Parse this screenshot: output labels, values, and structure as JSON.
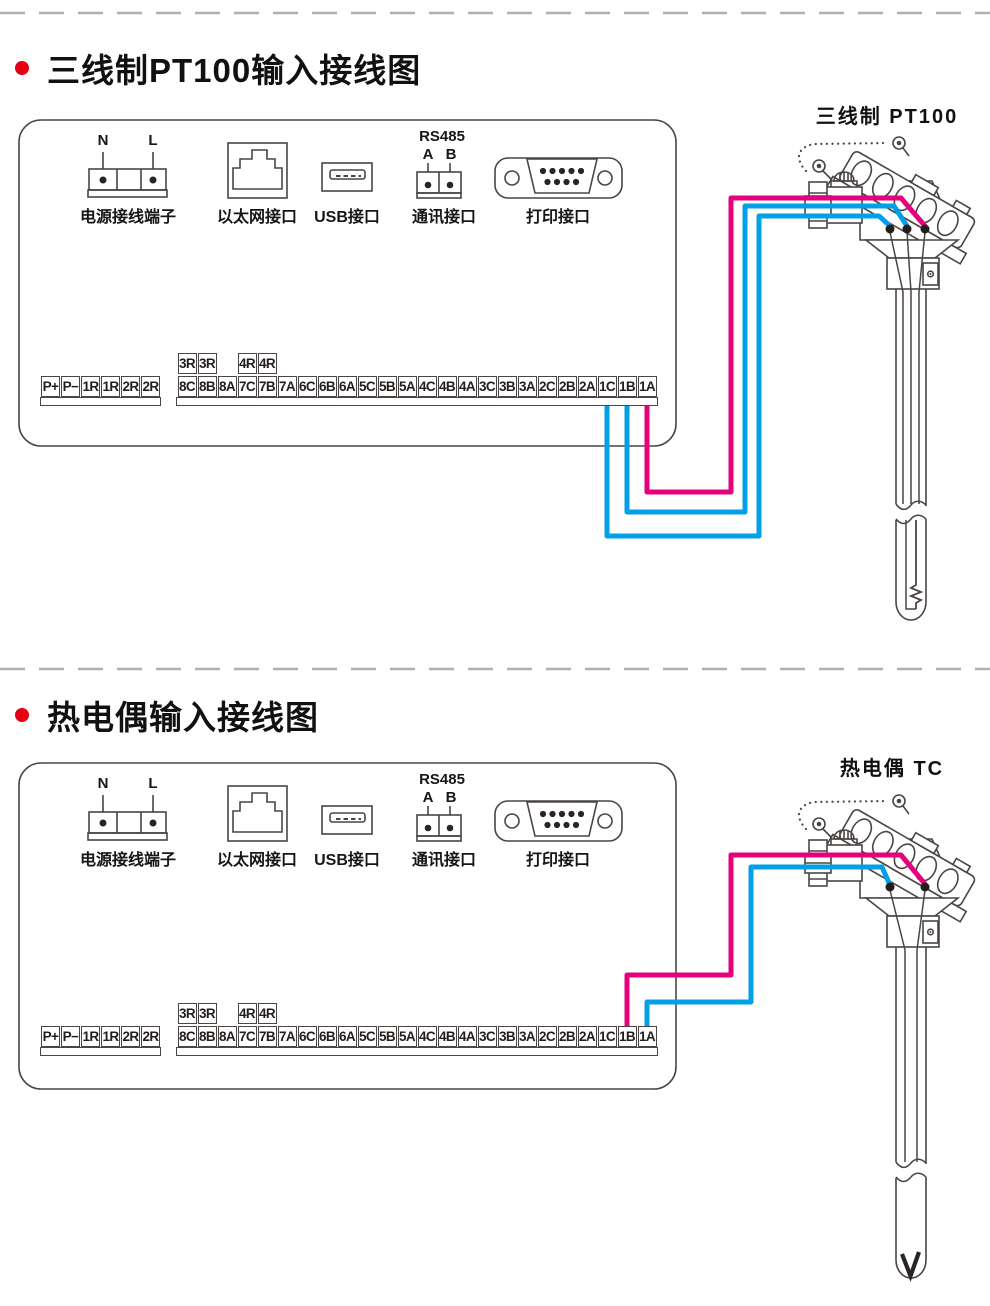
{
  "sections": [
    {
      "title": "三线制PT100输入接线图",
      "sensor": {
        "label": "三线制 PT100"
      },
      "wires": [
        {
          "terminal": "1A",
          "color": "#e5007e"
        },
        {
          "terminal": "1B",
          "color": "#00a0e9"
        },
        {
          "terminal": "1C",
          "color": "#00a0e9"
        }
      ]
    },
    {
      "title": "热电偶输入接线图",
      "sensor": {
        "label": "热电偶 TC"
      },
      "wires": [
        {
          "terminal": "1B",
          "color": "#e5007e"
        },
        {
          "terminal": "1A",
          "color": "#00a0e9"
        }
      ]
    }
  ],
  "panel": {
    "power": {
      "label": "电源接线端子",
      "pins": [
        "N",
        "L"
      ]
    },
    "ethernet": {
      "label": "以太网接口"
    },
    "usb": {
      "label": "USB接口"
    },
    "comm": {
      "label": "通讯接口",
      "bus": "RS485",
      "pins": [
        "A",
        "B"
      ]
    },
    "printer": {
      "label": "打印接口"
    },
    "terminals": {
      "left": [
        "P+",
        "P−",
        "1R",
        "1R",
        "2R",
        "2R"
      ],
      "relay_a": [
        "3R",
        "3R"
      ],
      "relay_b": [
        "4R",
        "4R"
      ],
      "main": [
        "8C",
        "8B",
        "8A",
        "7C",
        "7B",
        "7A",
        "6C",
        "6B",
        "6A",
        "5C",
        "5B",
        "5A",
        "4C",
        "4B",
        "4A",
        "3C",
        "3B",
        "3A",
        "2C",
        "2B",
        "2A",
        "1C",
        "1B",
        "1A"
      ]
    }
  },
  "colors": {
    "wire_pink": "#e5007e",
    "wire_blue": "#00a0e9",
    "bullet_red": "#e60012",
    "line_art": "#4a4543"
  }
}
